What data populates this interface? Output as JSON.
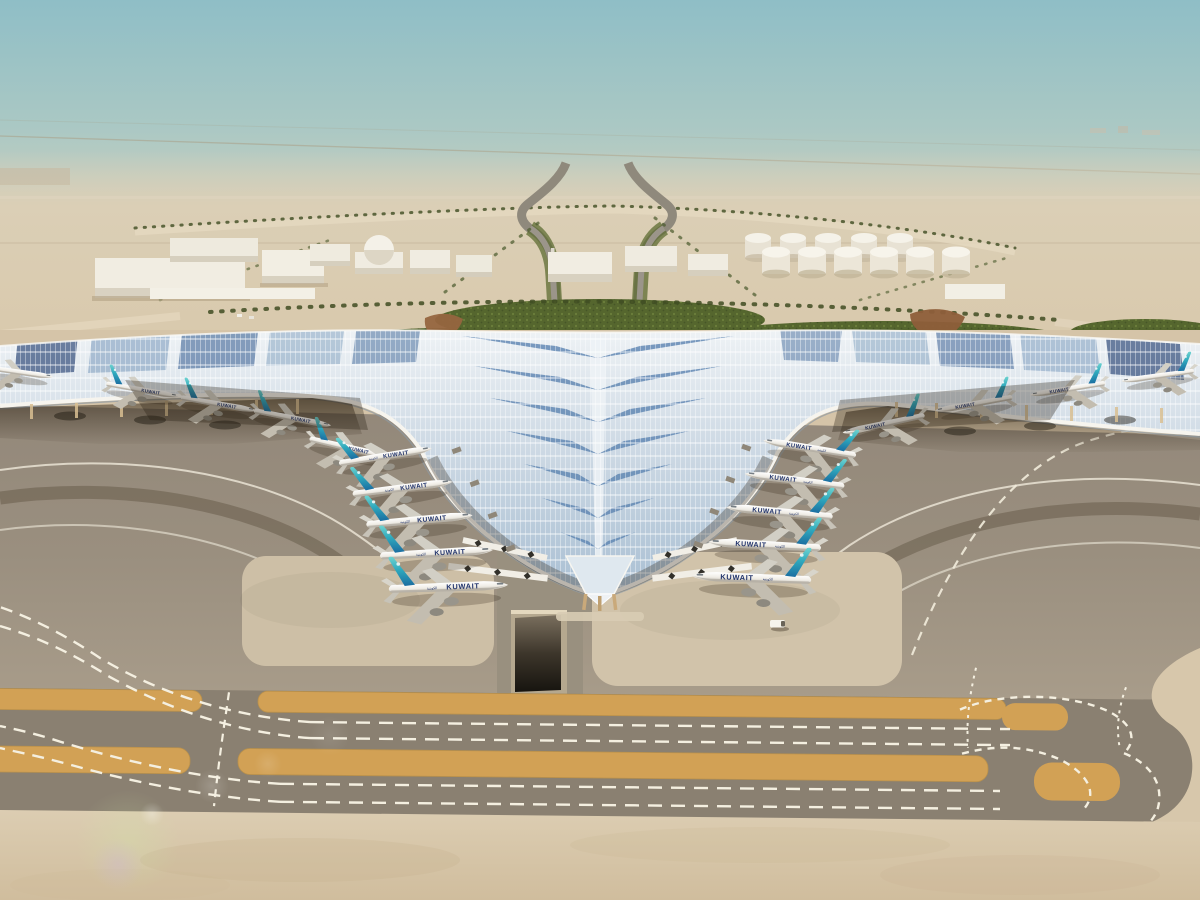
{
  "scene": {
    "title": "Aerial rendering of a trident-shaped desert airport terminal",
    "setting": "hazy desert horizon, palm-lined access roads, airside apron and taxiways",
    "airline_label": "KUWAIT",
    "airline_label_ar": "الكويتية",
    "aircraft": {
      "left_gate_count": 5,
      "right_gate_count": 5,
      "left_wing_count": 4,
      "right_wing_count": 4
    },
    "features": [
      "swooping solar-panel roof with leaf pattern",
      "teal-tailed widebody aircraft parked nose-in",
      "white warehouse buildings",
      "fuel tank farm",
      "palm-lined boulevards",
      "taxiways with orange shoulders and dashed white markings",
      "apron tunnel ramp",
      "service vehicle",
      "lens flare lower left"
    ]
  },
  "colors": {
    "sky_top": "#8fbec6",
    "horizon_haze": "#ded2bd",
    "desert_sand": "#d8c6a9",
    "roof_light": "#e7edf2",
    "roof_panel_blue": "#5f86b2",
    "tail_teal": "#3fbcc4",
    "tail_deep": "#1b6ea1",
    "fuselage_white": "#f3f2ee",
    "titles_navy": "#22346c",
    "apron_asphalt": "#958a7a",
    "taxiway_shoulder": "#d2a155",
    "marking_white": "#f4efe0",
    "landscape_green": "#55662e",
    "concrete": "#d8c8ac"
  }
}
